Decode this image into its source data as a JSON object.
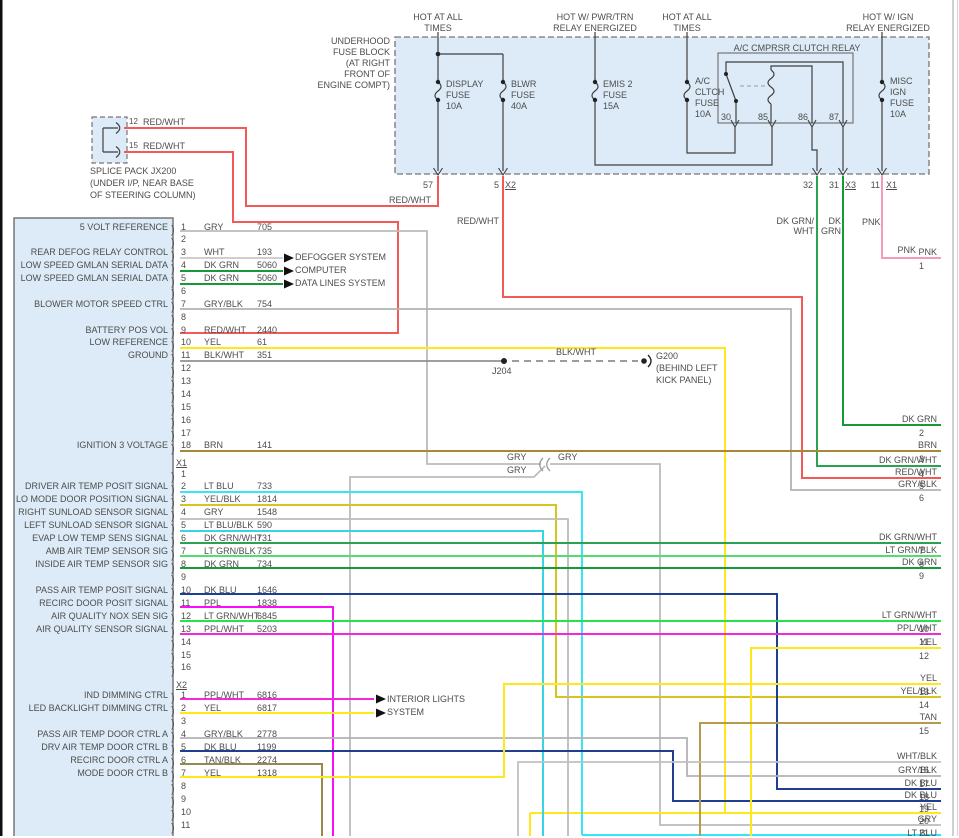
{
  "top_headers": [
    {
      "lines": [
        "HOT AT ALL",
        "TIMES"
      ]
    },
    {
      "lines": [
        "HOT W/ PWR/TRN",
        "RELAY ENERGIZED"
      ]
    },
    {
      "lines": [
        "HOT AT ALL",
        "TIMES"
      ]
    },
    {
      "lines": [
        "HOT W/ IGN",
        "RELAY ENERGIZED"
      ]
    }
  ],
  "fuse_block": {
    "label_lines": [
      "UNDERHOOD",
      "FUSE BLOCK",
      "(AT RIGHT",
      "FRONT OF",
      "ENGINE COMPT)"
    ],
    "fuses": [
      {
        "name_lines": [
          "DISPLAY",
          "FUSE",
          "10A"
        ]
      },
      {
        "name_lines": [
          "BLWR",
          "FUSE",
          "40A"
        ]
      },
      {
        "name_lines": [
          "EMIS 2",
          "FUSE",
          "15A"
        ]
      },
      {
        "name_lines": [
          "A/C",
          "CLTCH",
          "FUSE",
          "10A"
        ]
      },
      {
        "name_lines": [
          "MISC",
          "IGN",
          "FUSE",
          "10A"
        ]
      }
    ],
    "relay": {
      "title": "A/C CMPRSR CLUTCH RELAY",
      "pins": [
        "30",
        "85",
        "86",
        "87"
      ]
    },
    "exits": [
      {
        "num": "57"
      },
      {
        "num": "5",
        "conn": "X2"
      },
      {
        "num": "32"
      },
      {
        "num": "31",
        "conn": "X3"
      },
      {
        "num": "11",
        "conn": "X1"
      }
    ]
  },
  "splice_pack": {
    "outlets": [
      {
        "pin": "12",
        "wire": "RED/WHT"
      },
      {
        "pin": "15",
        "wire": "RED/WHT"
      }
    ],
    "label_lines": [
      "SPLICE PACK JX200",
      "(UNDER I/P, NEAR BASE",
      "OF STEERING COLUMN)"
    ]
  },
  "ground": {
    "junction": "J204",
    "wire": "BLK/WHT",
    "name": "G200",
    "location_lines": [
      "(BEHIND LEFT",
      "KICK PANEL)"
    ]
  },
  "inline_labels": {
    "red_wht_fuse57": "RED/WHT",
    "red_wht_blwr": "RED/WHT",
    "gry_a": "GRY",
    "gry_b": "GRY",
    "gry_c": "GRY",
    "dk_grn_wht_a": "DK GRN/",
    "dk_grn_wht_b": "WHT",
    "dk_grn_a": "DK",
    "dk_grn_b": "GRN",
    "pnk_a": "PNK",
    "pnk_b": "PNK"
  },
  "connector": {
    "sections": [
      {
        "label": "",
        "pins": [
          {
            "num": "1",
            "color": "GRY",
            "circuit": "705",
            "signal": "5 VOLT REFERENCE"
          },
          {
            "num": "2"
          },
          {
            "num": "3",
            "color": "WHT",
            "circuit": "193",
            "signal": "REAR DEFOG RELAY CONTROL",
            "arrow": "DEFOGGER SYSTEM"
          },
          {
            "num": "4",
            "color": "DK GRN",
            "circuit": "5060",
            "signal": "LOW SPEED GMLAN SERIAL DATA",
            "arrow": "COMPUTER"
          },
          {
            "num": "5",
            "color": "DK GRN",
            "circuit": "5060",
            "signal": "LOW SPEED GMLAN SERIAL DATA",
            "arrow": "DATA LINES SYSTEM"
          },
          {
            "num": "6"
          },
          {
            "num": "7",
            "color": "GRY/BLK",
            "circuit": "754",
            "signal": "BLOWER MOTOR SPEED CTRL"
          },
          {
            "num": "8"
          },
          {
            "num": "9",
            "color": "RED/WHT",
            "circuit": "2440",
            "signal": "BATTERY POS VOL"
          },
          {
            "num": "10",
            "color": "YEL",
            "circuit": "61",
            "signal": "LOW REFERENCE"
          },
          {
            "num": "11",
            "color": "BLK/WHT",
            "circuit": "351",
            "signal": "GROUND"
          },
          {
            "num": "12"
          },
          {
            "num": "13"
          },
          {
            "num": "14"
          },
          {
            "num": "15"
          },
          {
            "num": "16"
          },
          {
            "num": "17"
          },
          {
            "num": "18",
            "color": "BRN",
            "circuit": "141",
            "signal": "IGNITION 3 VOLTAGE"
          }
        ]
      },
      {
        "label": "X1",
        "pins": [
          {
            "num": "1"
          },
          {
            "num": "2",
            "color": "LT BLU",
            "circuit": "733",
            "signal": "DRIVER AIR TEMP POSIT SIGNAL"
          },
          {
            "num": "3",
            "color": "YEL/BLK",
            "circuit": "1814",
            "signal": "LO MODE DOOR POSITION SIGNAL"
          },
          {
            "num": "4",
            "color": "GRY",
            "circuit": "1548",
            "signal": "RIGHT SUNLOAD SENSOR SIGNAL"
          },
          {
            "num": "5",
            "color": "LT BLU/BLK",
            "circuit": "590",
            "signal": "LEFT SUNLOAD SENSOR SIGNAL"
          },
          {
            "num": "6",
            "color": "DK GRN/WHT",
            "circuit": "731",
            "signal": "EVAP LOW TEMP SENS SIGNAL"
          },
          {
            "num": "7",
            "color": "LT GRN/BLK",
            "circuit": "735",
            "signal": "AMB AIR TEMP SENSOR SIG"
          },
          {
            "num": "8",
            "color": "DK GRN",
            "circuit": "734",
            "signal": "INSIDE AIR TEMP SENSOR SIG"
          },
          {
            "num": "9"
          },
          {
            "num": "10",
            "color": "DK BLU",
            "circuit": "1646",
            "signal": "PASS AIR TEMP POSIT SIGNAL"
          },
          {
            "num": "11",
            "color": "PPL",
            "circuit": "1838",
            "signal": "RECIRC DOOR POSIT SIGNAL"
          },
          {
            "num": "12",
            "color": "LT GRN/WHT",
            "circuit": "6845",
            "signal": "AIR QUALITY NOX SEN SIG"
          },
          {
            "num": "13",
            "color": "PPL/WHT",
            "circuit": "5203",
            "signal": "AIR QUALITY SENSOR SIGNAL"
          },
          {
            "num": "14"
          },
          {
            "num": "15"
          },
          {
            "num": "16"
          }
        ]
      },
      {
        "label": "X2",
        "pins": [
          {
            "num": "1",
            "color": "PPL/WHT",
            "circuit": "6816",
            "signal": "IND DIMMING CTRL",
            "arrow": "INTERIOR LIGHTS"
          },
          {
            "num": "2",
            "color": "YEL",
            "circuit": "6817",
            "signal": "LED BACKLIGHT DIMMING CTRL",
            "arrow": "SYSTEM"
          },
          {
            "num": "3"
          },
          {
            "num": "4",
            "color": "GRY/BLK",
            "circuit": "2778",
            "signal": "PASS AIR TEMP DOOR CTRL A"
          },
          {
            "num": "5",
            "color": "DK BLU",
            "circuit": "1199",
            "signal": "DRV AIR TEMP DOOR CTRL B"
          },
          {
            "num": "6",
            "color": "TAN/BLK",
            "circuit": "2274",
            "signal": "RECIRC DOOR CTRL A"
          },
          {
            "num": "7",
            "color": "YEL",
            "circuit": "1318",
            "signal": "MODE DOOR CTRL B"
          },
          {
            "num": "8"
          },
          {
            "num": "9"
          },
          {
            "num": "10"
          },
          {
            "num": "11"
          }
        ]
      }
    ]
  },
  "right_exits": [
    {
      "num": "1",
      "color": "PNK"
    },
    {
      "num": "2",
      "color": "DK GRN"
    },
    {
      "num": "3",
      "color": "BRN"
    },
    {
      "num": "4",
      "color": "DK GRN/WHT"
    },
    {
      "num": "5",
      "color": "RED/WHT"
    },
    {
      "num": "6",
      "color": "GRY/BLK"
    },
    {
      "num": "7",
      "color": "DK GRN/WHT"
    },
    {
      "num": "8",
      "color": "LT GRN/BLK"
    },
    {
      "num": "9",
      "color": "DK GRN"
    },
    {
      "num": "10",
      "color": "LT GRN/WHT"
    },
    {
      "num": "11",
      "color": "PPL/WHT"
    },
    {
      "num": "12",
      "color": "YEL"
    },
    {
      "num": "13",
      "color": "YEL"
    },
    {
      "num": "14",
      "color": "YEL/BLK"
    },
    {
      "num": "15",
      "color": "TAN"
    },
    {
      "num": "16",
      "color": "WHT/BLK"
    },
    {
      "num": "17",
      "color": "GRY/BLK"
    },
    {
      "num": "18",
      "color": "DK BLU"
    },
    {
      "num": "19",
      "color": "DK BLU"
    },
    {
      "num": "20",
      "color": "YEL"
    },
    {
      "num": "21",
      "color": "GRY"
    },
    {
      "num": "",
      "color": "LT BLU"
    }
  ],
  "wire_colors": {
    "GRY": "#bcbcbc",
    "WHT": "#c8c8c8",
    "DK GRN": "#169a38",
    "GRY/BLK": "#b2b2b2",
    "RED/WHT": "#f25a5a",
    "YEL": "#ffe81a",
    "BLK/WHT": "#909090",
    "BRN": "#a8873b",
    "LT BLU": "#35e6f7",
    "YEL/BLK": "#d6c51f",
    "LT BLU/BLK": "#38d4e5",
    "DK GRN/WHT": "#2da152",
    "LT GRN/BLK": "#53dd6e",
    "DK BLU": "#1f3d91",
    "PPL": "#fb0cfb",
    "LT GRN/WHT": "#27e24b",
    "PPL/WHT": "#f527d8",
    "TAN/BLK": "#99884d",
    "TAN": "#b69a4e",
    "WHT/BLK": "#c0c0c0",
    "PNK": "#f79ab4"
  }
}
